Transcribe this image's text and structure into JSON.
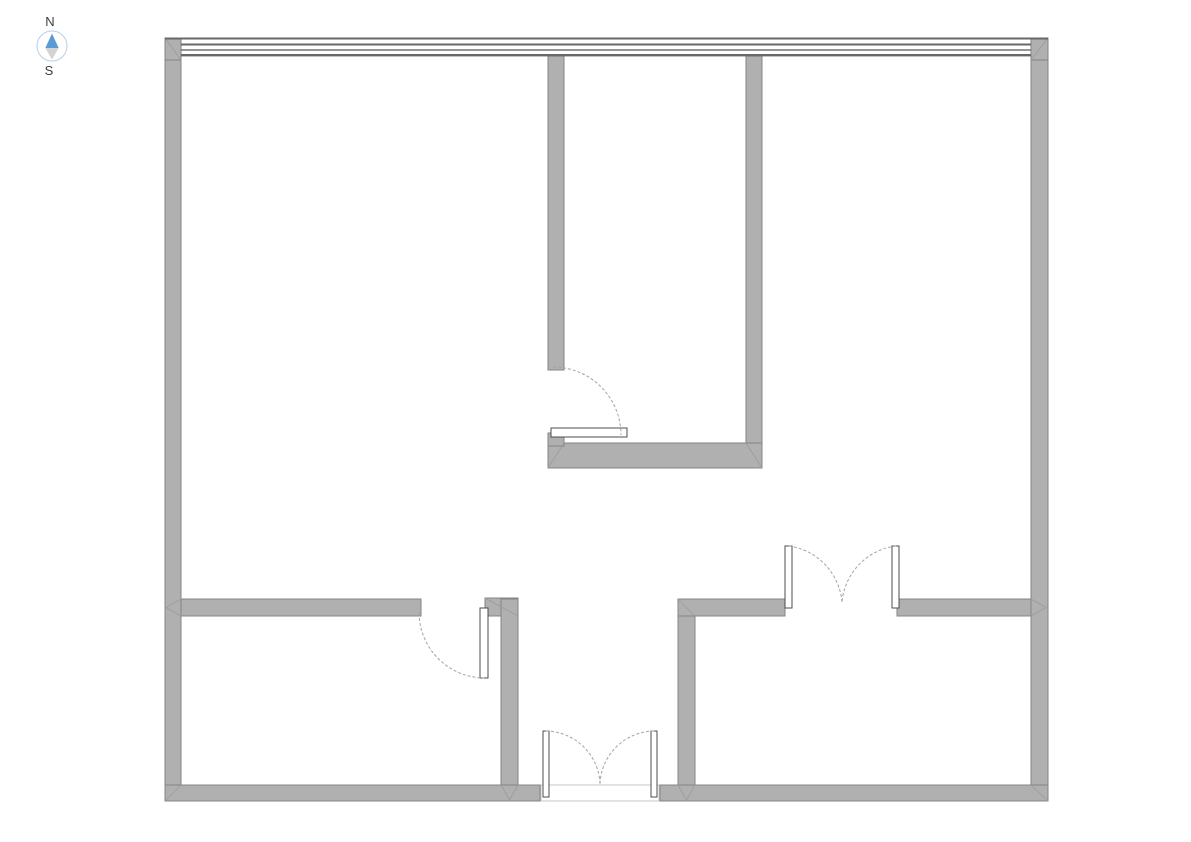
{
  "compass": {
    "north_label": "N",
    "south_label": "S",
    "label_color": "#3c3c3c",
    "circle_color": "#b5cfe7",
    "north_needle_color": "#5b9bd5",
    "south_needle_color": "#d4d4d4"
  },
  "plan": {
    "background": "#ffffff",
    "wall_fill": "#b0b0b0",
    "wall_stroke": "#858585",
    "window_line_color": "#686868",
    "arc_color": "#a3a3a3",
    "leaf_fill": "#ffffff",
    "leaf_stroke": "#4d4d4d",
    "miter_color": "#9b9b9b",
    "threshold_stroke": "#c6c6c6",
    "walls": [
      [
        165,
        38,
        16,
        763,
        "wall-exterior-west"
      ],
      [
        1031,
        38,
        17,
        763,
        "wall-exterior-east"
      ],
      [
        165,
        785,
        375,
        16,
        "wall-exterior-south-west-segment"
      ],
      [
        660,
        785,
        388,
        16,
        "wall-exterior-south-east-segment"
      ],
      [
        165,
        38,
        16,
        22,
        "wall-corner-cap-northwest"
      ],
      [
        1031,
        38,
        17,
        22,
        "wall-corner-cap-northeast"
      ],
      [
        548,
        56,
        16,
        314,
        "wall-interior-north-room-west"
      ],
      [
        746,
        56,
        16,
        412,
        "wall-interior-north-room-east"
      ],
      [
        548,
        443,
        214,
        25,
        "wall-interior-north-room-south"
      ],
      [
        548,
        433,
        16,
        13,
        "wall-interior-north-room-door-stub"
      ],
      [
        181,
        599,
        240,
        17,
        "wall-interior-west-wing"
      ],
      [
        485,
        598,
        33,
        18,
        "wall-interior-door-head"
      ],
      [
        501,
        599,
        17,
        186,
        "wall-interior-divider-west"
      ],
      [
        678,
        599,
        17,
        186,
        "wall-interior-divider-east"
      ],
      [
        678,
        599,
        107,
        17,
        "wall-interior-southeast-room-north-left"
      ],
      [
        897,
        599,
        134,
        17,
        "wall-interior-southeast-room-north-right"
      ]
    ],
    "window_lines": [
      [
        165,
        37.5,
        883,
        2
      ],
      [
        181,
        43.5,
        850,
        2
      ],
      [
        181,
        49.3,
        850,
        1.4
      ],
      [
        181,
        54.0,
        850,
        2.4
      ]
    ],
    "thresholds": [
      [
        541,
        785,
        118,
        16
      ]
    ],
    "door_leaves": [
      [
        551,
        428,
        76,
        9,
        "door-leaf-north-room"
      ],
      [
        480,
        608,
        8,
        70,
        "door-leaf-west-room"
      ],
      [
        785,
        546,
        7,
        62,
        "double-door-leaf-left-southeast-room"
      ],
      [
        892,
        546,
        7,
        62,
        "double-door-leaf-right-southeast-room"
      ],
      [
        543,
        731,
        6,
        66,
        "double-door-leaf-left-south-entry"
      ],
      [
        651,
        731,
        6,
        66,
        "double-door-leaf-right-south-entry"
      ]
    ],
    "door_arcs": [
      [
        "M 553 367 A 68 68 0 0 1 621 435",
        "door-swing-arc-north-room"
      ],
      [
        "M 419 613 A 66 66 0 0 0 484 678",
        "door-swing-arc-west-room"
      ],
      [
        "M 789 546 A 62 62 0 0 1 842 602",
        "door-swing-arc-left-southeast-room"
      ],
      [
        "M 896 546 A 62 62 0 0 0 842 602",
        "door-swing-arc-right-southeast-room"
      ],
      [
        "M 546 731 A 55 55 0 0 1 600 784",
        "door-swing-arc-left-south-entry"
      ],
      [
        "M 654 731 A 55 55 0 0 0 600 784",
        "door-swing-arc-right-south-entry"
      ]
    ],
    "miters": [
      [
        165,
        38,
        181,
        60
      ],
      [
        1048,
        38,
        1031,
        60
      ],
      [
        165,
        801,
        181,
        785
      ],
      [
        1048,
        801,
        1031,
        785
      ],
      [
        181,
        599,
        166,
        607.5
      ],
      [
        181,
        616,
        166,
        607.5
      ],
      [
        1031,
        599,
        1046,
        607.5
      ],
      [
        1031,
        616,
        1046,
        607.5
      ],
      [
        485,
        598,
        518,
        616
      ],
      [
        501,
        785,
        509.5,
        800
      ],
      [
        518,
        785,
        509.5,
        800
      ],
      [
        678,
        785,
        686.5,
        800
      ],
      [
        695,
        785,
        686.5,
        800
      ],
      [
        678,
        599,
        695,
        616
      ],
      [
        548,
        468,
        564,
        443
      ],
      [
        762,
        468,
        746,
        443
      ]
    ]
  }
}
